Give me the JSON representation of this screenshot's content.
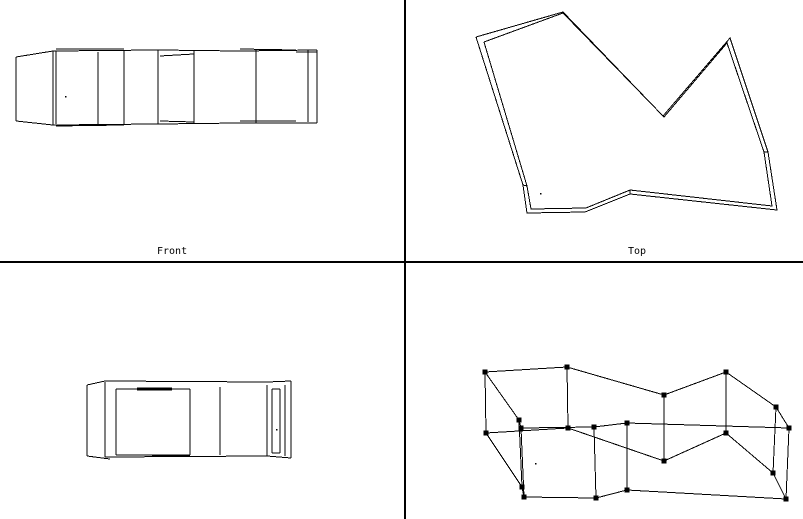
{
  "window": {
    "width": 803,
    "height": 519,
    "background_color": "#ffffff",
    "stroke_color": "#000000"
  },
  "dividers": {
    "vertical": {
      "x": 404,
      "y": 0,
      "width": 2,
      "height": 519
    },
    "horizontal": {
      "x": 0,
      "y": 261,
      "width": 803,
      "height": 2
    }
  },
  "viewports": {
    "front": {
      "label": "Front",
      "segments": [
        [
          16,
          57,
          16,
          121
        ],
        [
          16,
          57,
          53,
          51
        ],
        [
          16,
          121,
          53,
          125
        ],
        [
          53,
          51,
          53,
          125
        ],
        [
          56,
          51,
          56,
          124
        ],
        [
          53,
          51,
          158,
          50
        ],
        [
          158,
          50,
          240,
          51
        ],
        [
          240,
          51,
          317,
          50
        ],
        [
          56,
          49,
          124,
          49
        ],
        [
          160,
          56,
          194,
          54
        ],
        [
          240,
          49,
          296,
          50
        ],
        [
          296,
          52,
          317,
          52
        ],
        [
          53,
          125,
          158,
          124
        ],
        [
          158,
          124,
          240,
          123
        ],
        [
          240,
          123,
          317,
          123
        ],
        [
          56,
          126,
          124,
          125
        ],
        [
          160,
          121,
          194,
          122
        ],
        [
          240,
          121,
          296,
          121
        ],
        [
          98,
          52,
          98,
          124
        ],
        [
          124,
          51,
          124,
          124
        ],
        [
          158,
          50,
          158,
          124
        ],
        [
          194,
          50,
          194,
          123
        ],
        [
          256,
          50,
          256,
          123
        ],
        [
          308,
          50,
          308,
          122
        ],
        [
          317,
          50,
          317,
          123
        ]
      ],
      "pivot_dot": [
        65,
        96
      ]
    },
    "top": {
      "label": "Top",
      "outer_outline": [
        [
          476,
          37
        ],
        [
          563,
          12
        ],
        [
          663,
          116
        ],
        [
          730,
          38
        ],
        [
          768,
          152
        ],
        [
          777,
          210
        ],
        [
          630,
          194
        ],
        [
          585,
          212
        ],
        [
          527,
          213
        ],
        [
          523,
          185
        ],
        [
          476,
          37
        ]
      ],
      "inner_outline": [
        [
          484,
          42
        ],
        [
          563,
          13
        ],
        [
          664,
          117
        ],
        [
          727,
          43
        ],
        [
          764,
          152
        ],
        [
          772,
          206
        ],
        [
          630,
          190
        ],
        [
          586,
          208
        ],
        [
          531,
          209
        ],
        [
          527,
          186
        ],
        [
          484,
          42
        ]
      ],
      "connector_segments": [
        [
          523,
          185,
          527,
          186
        ],
        [
          768,
          152,
          764,
          152
        ],
        [
          630,
          194,
          630,
          190
        ]
      ],
      "pivot_dot": [
        540,
        193
      ]
    },
    "side": {
      "segments": [
        [
          87,
          385,
          87,
          456
        ],
        [
          87,
          385,
          105,
          381
        ],
        [
          87,
          456,
          110,
          459
        ],
        [
          105,
          382,
          105,
          457
        ],
        [
          105,
          381,
          267,
          382
        ],
        [
          105,
          457,
          267,
          456
        ],
        [
          267,
          382,
          291,
          381
        ],
        [
          267,
          456,
          291,
          458
        ],
        [
          291,
          381,
          291,
          458
        ],
        [
          116,
          389,
          190,
          389
        ],
        [
          137,
          388,
          172,
          388
        ],
        [
          137,
          390,
          172,
          390
        ],
        [
          116,
          455,
          190,
          455
        ],
        [
          152,
          456,
          190,
          456
        ],
        [
          116,
          389,
          116,
          455
        ],
        [
          190,
          389,
          190,
          455
        ],
        [
          220,
          387,
          220,
          455
        ],
        [
          267,
          385,
          267,
          456
        ],
        [
          272,
          389,
          272,
          453
        ],
        [
          280,
          389,
          280,
          453
        ],
        [
          272,
          389,
          280,
          389
        ],
        [
          272,
          453,
          280,
          453
        ],
        [
          285,
          385,
          285,
          456
        ]
      ],
      "pivot_dot": [
        276,
        429
      ]
    },
    "perspective": {
      "top_face": [
        [
          485,
          372
        ],
        [
          567,
          367
        ],
        [
          664,
          395
        ],
        [
          726,
          372
        ],
        [
          776,
          407
        ],
        [
          789,
          428
        ],
        [
          627,
          423
        ],
        [
          594,
          427
        ],
        [
          521,
          428
        ],
        [
          519,
          420
        ],
        [
          485,
          372
        ]
      ],
      "bottom_face": [
        [
          486,
          433
        ],
        [
          568,
          428
        ],
        [
          664,
          461
        ],
        [
          726,
          433
        ],
        [
          773,
          473
        ],
        [
          786,
          499
        ],
        [
          627,
          490
        ],
        [
          596,
          498
        ],
        [
          524,
          497
        ],
        [
          522,
          487
        ],
        [
          486,
          433
        ]
      ],
      "vertex_marker_size": 5,
      "pivot_dot": [
        535,
        463
      ]
    }
  },
  "labels": {
    "front": {
      "text": "Front"
    },
    "top": {
      "text": "Top"
    }
  }
}
